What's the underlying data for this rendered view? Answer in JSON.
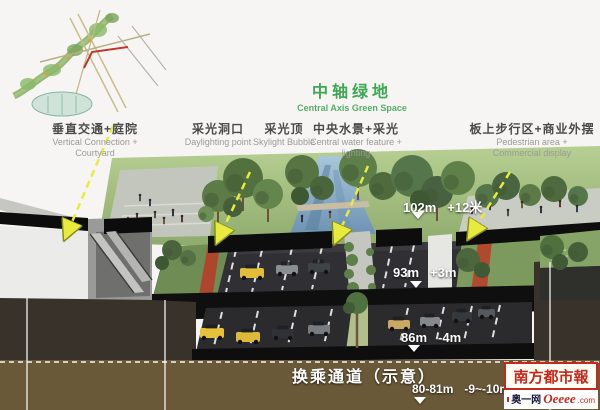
{
  "title": {
    "zh": "中轴绿地",
    "en": "Central Axis Green Space"
  },
  "feature_labels": [
    {
      "zh": "垂直交通+庭院",
      "en1": "Vertical Connection +",
      "en2": "Courtyard"
    },
    {
      "zh": "采光洞口",
      "en1": "Daylighting point",
      "en2": ""
    },
    {
      "zh": "采光顶",
      "en1": "Skylight Bubble",
      "en2": ""
    },
    {
      "zh": "中央水景+采光",
      "en1": "Central water feature +",
      "en2": "lighting"
    },
    {
      "zh": "板上步行区+商业外摆",
      "en1": "Pedestrian area +",
      "en2": "Commercial display"
    }
  ],
  "levels": [
    {
      "elevation": "102m",
      "relative": "+12米"
    },
    {
      "elevation": "93m",
      "relative": "+3m"
    },
    {
      "elevation": "86m",
      "relative": "-4m"
    },
    {
      "elevation": "80-81m",
      "relative": "-9~-10m"
    }
  ],
  "caption": "换乘通道（示意）",
  "branding": {
    "newspaper": "南方都市報",
    "site": "奥一网",
    "site_en": "Oeeee",
    "tld": ".com"
  },
  "colors": {
    "title_green": "#3da853",
    "arrow_yellow": "#e8ea3e",
    "brand_red": "#c5281c",
    "road_dark": "#303034",
    "soil_dark": "#39322a",
    "soil_light": "#6a5939",
    "water_blue": "#7fa4c4",
    "grass_green": "#93b173",
    "path_red": "#b0492e"
  }
}
